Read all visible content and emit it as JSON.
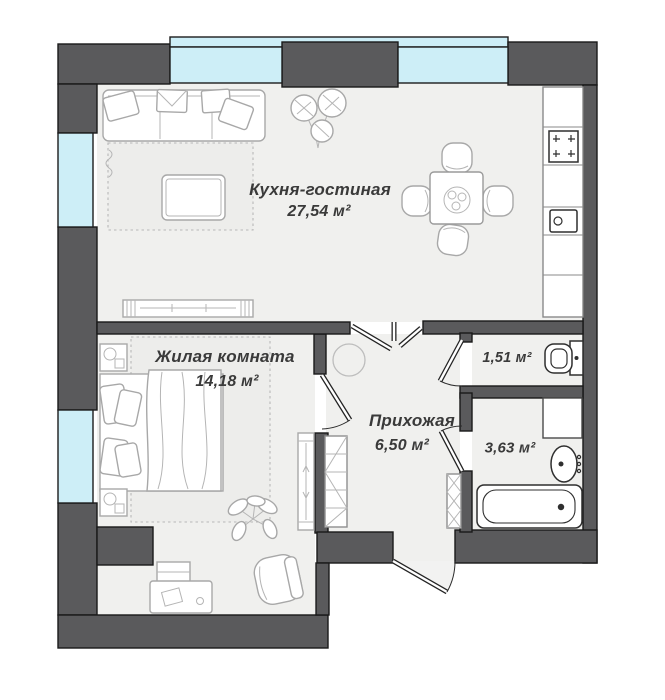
{
  "rooms": {
    "kitchen_living": {
      "name": "Кухня-гостиная",
      "area": "27,54 м²"
    },
    "bedroom": {
      "name": "Жилая комната",
      "area": "14,18 м²"
    },
    "hallway": {
      "name": "Прихожая",
      "area": "6,50 м²"
    },
    "toilet": {
      "area": "1,51 м²"
    },
    "bathroom": {
      "area": "3,63 м²"
    }
  },
  "colors": {
    "wall": "#5a5a5c",
    "window": "#cdeef7",
    "floor": "#f0f0ee",
    "text": "#3a3a3a"
  }
}
